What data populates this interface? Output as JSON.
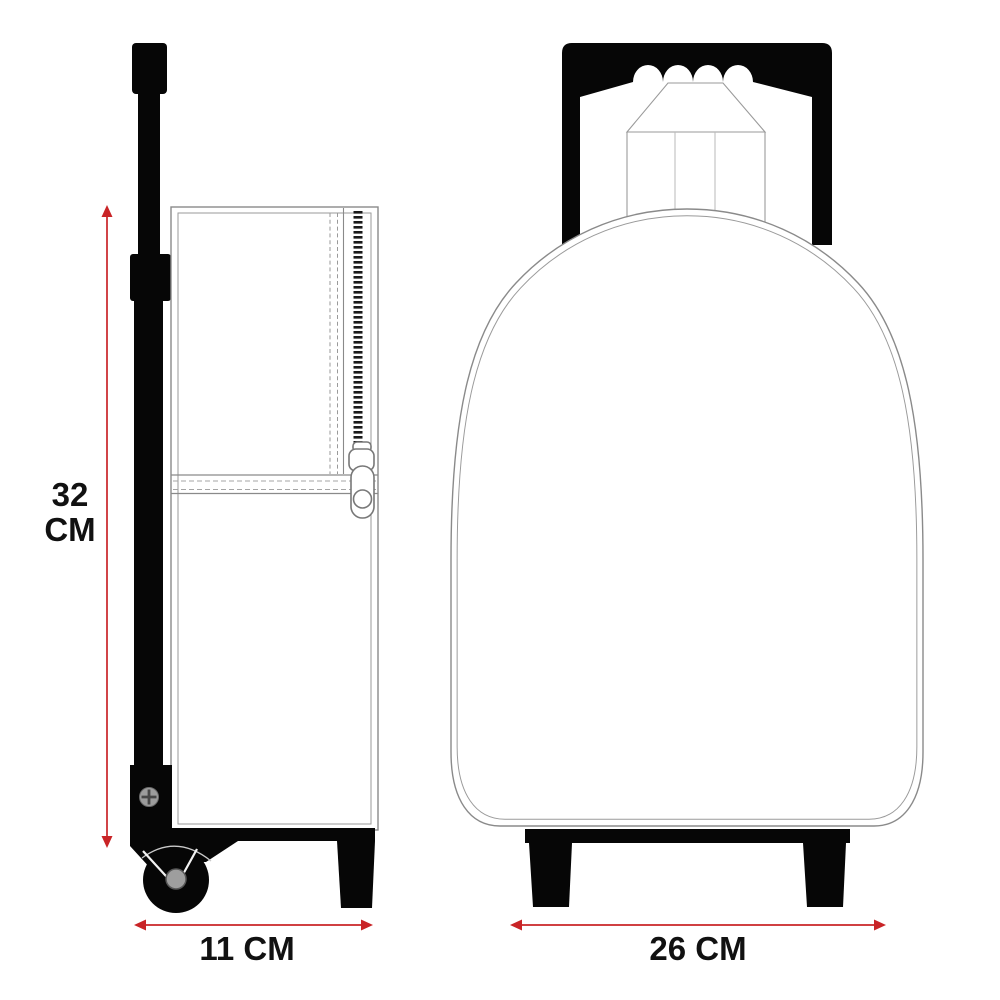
{
  "dimensions": {
    "height": {
      "value": "32",
      "unit": "CM"
    },
    "depth": {
      "label": "11 CM"
    },
    "width": {
      "label": "26 CM"
    }
  },
  "colors": {
    "accent_red": "#c92427",
    "outline_gray": "#8a8a8a",
    "ink_black": "#060606"
  }
}
